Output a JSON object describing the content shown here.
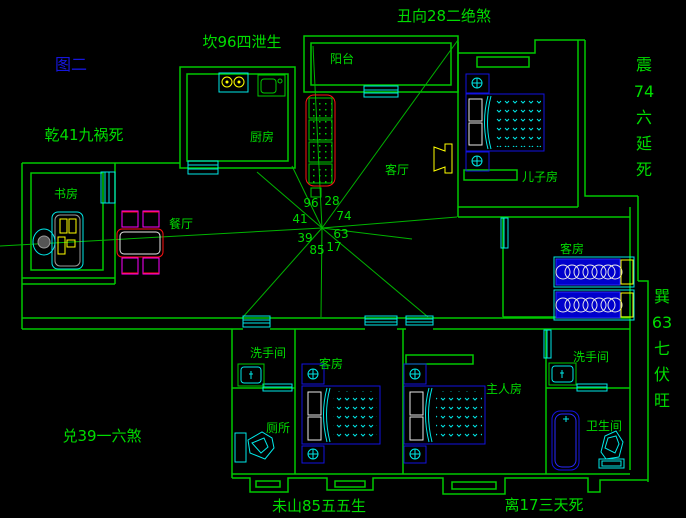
{
  "figure_label": {
    "text": "图二",
    "color": "#1616dd"
  },
  "palette": {
    "background": "#000000",
    "wall_green": "#00c800",
    "text_green": "#00dc00",
    "ray_green": "#00b400",
    "cyan": "#00e8e8",
    "furniture_blue": "#1212e0",
    "yellow": "#ffff00",
    "red": "#ff1212",
    "magenta": "#ff00ff",
    "white": "#e8e8e8"
  },
  "fengshui_labels": {
    "top": "坎96四泄生",
    "top_right": "丑向28二绝煞",
    "left_upper": "乾41九祸死",
    "left_lower": "兑39一六煞",
    "bottom_left": "未山85五五生",
    "bottom_right": "离17三天死",
    "right_upper": {
      "chars": [
        "震",
        "74",
        "六",
        "延",
        "死"
      ]
    },
    "right_lower": {
      "chars": [
        "巽",
        "63",
        "七",
        "伏",
        "旺"
      ]
    }
  },
  "compass": {
    "numbers": {
      "nw": "96",
      "n": "28",
      "w": "41",
      "e": "74",
      "wsw": "39",
      "ese": "63",
      "sw": "85",
      "s": "17"
    }
  },
  "rooms": {
    "kitchen": "厨房",
    "balcony": "阳台",
    "living": "客厅",
    "study": "书房",
    "dining": "餐厅",
    "son": "儿子房",
    "guest_right": "客房",
    "guest_bottom": "客房",
    "master": "主人房",
    "washroom_left": "洗手间",
    "toilet": "厕所",
    "washroom_right": "洗手间",
    "bathroom": "卫生间"
  }
}
